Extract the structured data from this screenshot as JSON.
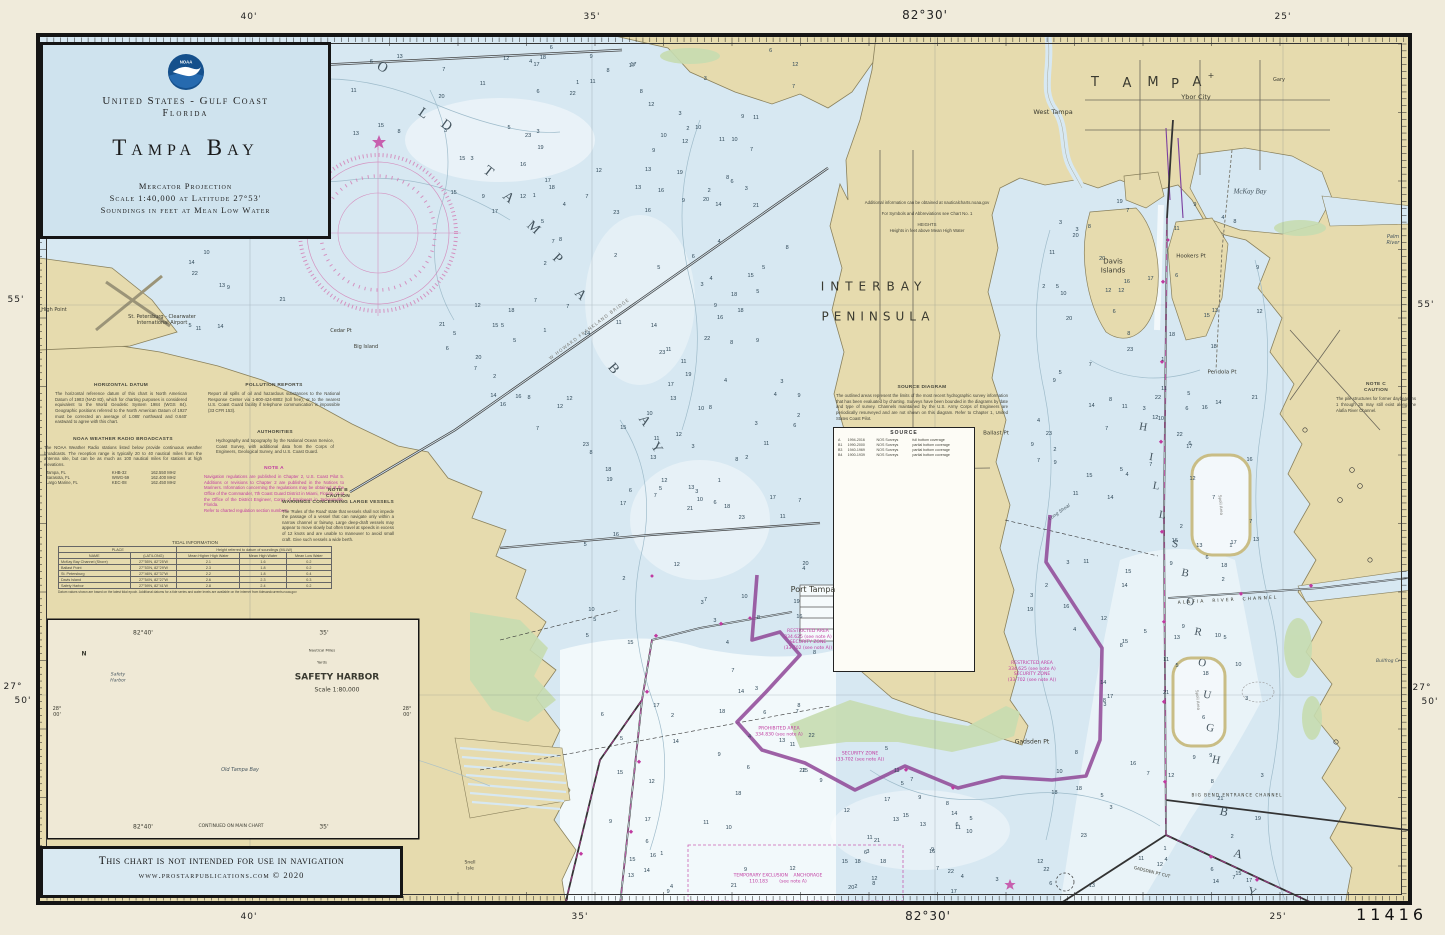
{
  "chart": {
    "number": "11416"
  },
  "title_block": {
    "region": "United States - Gulf Coast",
    "state": "Florida",
    "title": "Tampa Bay",
    "projection": "Mercator Projection",
    "scale": "Scale 1:40,000 at Latitude 27°53'",
    "soundings_note": "Soundings in feet at Mean Low Water",
    "logo": "noaa-logo"
  },
  "disclaimer": {
    "line1": "This chart is not intended for use in navigation",
    "line2": "www.prostarpublications.com  © 2020"
  },
  "colors": {
    "land": "#e6dbae",
    "water": "#d7e8f2",
    "marsh": "#c7dcb0",
    "deep": "#f7fbfd",
    "magenta": "#c03aa0",
    "purple": "#8f4796",
    "teal": "#9ccfcd",
    "titlebox": "#cfe3ee"
  },
  "margin_labels": [
    {
      "t": "40'",
      "x": 249,
      "y": 17
    },
    {
      "t": "35'",
      "x": 592,
      "y": 17
    },
    {
      "t": "82°30'",
      "x": 925,
      "y": 15,
      "s": 12
    },
    {
      "t": "25'",
      "x": 1283,
      "y": 17
    },
    {
      "t": "40'",
      "x": 249,
      "y": 917
    },
    {
      "t": "35'",
      "x": 580,
      "y": 917
    },
    {
      "t": "82°30'",
      "x": 928,
      "y": 916,
      "s": 12
    },
    {
      "t": "25'",
      "x": 1278,
      "y": 917
    },
    {
      "t": "55'",
      "x": 16,
      "y": 300
    },
    {
      "t": "27°",
      "x": 13,
      "y": 687
    },
    {
      "t": "50'",
      "x": 23,
      "y": 701
    },
    {
      "t": "55'",
      "x": 1426,
      "y": 305
    },
    {
      "t": "27°",
      "x": 1422,
      "y": 688
    },
    {
      "t": "50'",
      "x": 1430,
      "y": 702
    }
  ],
  "notes": [
    {
      "id": "horizontal-datum",
      "title": "HORIZONTAL DATUM",
      "x": 55,
      "y": 383,
      "w": 132,
      "body": "The horizontal reference datum of this chart is North American Datum of 1983 (NAD 83), which for charting purposes is considered equivalent to the World Geodetic System 1984 (WGS 84). Geographic positions referred to the North American Datum of 1927 must be corrected an average of 1.085' northward and 0.640' eastward to agree with this chart."
    },
    {
      "id": "weather-radio",
      "title": "NOAA WEATHER RADIO BROADCASTS",
      "x": 44,
      "y": 437,
      "w": 158,
      "body": "The NOAA Weather Radio stations listed below provide continuous weather broadcasts. The reception range is typically 20 to 40 nautical miles from the antenna site, but can be as much as 100 nautical miles for stations at high elevations.",
      "rows": [
        [
          "Tampa, FL",
          "KHB-32",
          "162.550 MHz"
        ],
        [
          "Sarasota, FL",
          "WWG-59",
          "162.400 MHz"
        ],
        [
          "Largo Marine, FL",
          "KEC-08",
          "162.450 MHz"
        ]
      ]
    },
    {
      "id": "pollution-reports",
      "title": "POLLUTION REPORTS",
      "x": 208,
      "y": 383,
      "w": 132,
      "body": "Report all spills of oil and hazardous substances to the National Response Center via 1-800-424-8802 (toll free), or to the nearest U.S. Coast Guard facility if telephone communication is impossible (33 CFR 153)."
    },
    {
      "id": "authorities",
      "title": "AUTHORITIES",
      "x": 216,
      "y": 430,
      "w": 118,
      "body": "Hydrography and topography by the National Ocean Service, Coast Survey, with additional data from the Corps of Engineers, Geological Survey, and U.S. Coast Guard."
    },
    {
      "id": "note-a",
      "title": "NOTE A",
      "x": 204,
      "y": 466,
      "w": 140,
      "c": "mag",
      "body": "Navigation regulations are published in Chapter 2, U.S. Coast Pilot 5. Additions or revisions to Chapter 2 are published in the Notices to Mariners. Information concerning the regulations may be obtained at the Office of the Commander, 7th Coast Guard District in Miami, Florida, or at the Office of the District Engineer, Corps of Engineers in Jacksonville, Florida.\nRefer to charted regulation section numbers."
    },
    {
      "id": "note-b",
      "title": "NOTE B\nCAUTION\nWARNINGS CONCERNING LARGE VESSELS",
      "x": 282,
      "y": 488,
      "w": 112,
      "body": "The 'Rules of the Road' state that vessels shall not impede the passage of a vessel that can navigate only within a narrow channel or fairway. Large deep-draft vessels may appear to move slowly but often travel at speeds in excess of 12 knots and are unable to maneuver to avoid small craft. Give such vessels a wide berth."
    },
    {
      "id": "heights",
      "title": "",
      "x": 862,
      "y": 200,
      "w": 130,
      "c": "center",
      "body": "Additional information can be obtained at nauticalcharts.noaa.gov\n\nFor Symbols and Abbreviations see Chart No. 1\n\nHEIGHTS\nHeights in feet above Mean High Water"
    },
    {
      "id": "note-c",
      "title": "NOTE C\nCAUTION",
      "x": 1336,
      "y": 382,
      "w": 80,
      "body": "The pile structures for former daybeacons 1 through 35 may still exist along the Alafia River Channel."
    },
    {
      "id": "source-diagram",
      "title": "SOURCE DIAGRAM",
      "x": 836,
      "y": 385,
      "w": 172,
      "body": "The outlined areas represent the limits of the most recent hydrographic survey information that has been evaluated by charting. Surveys have been bounded in the diagrams by date and type of survey. Channels maintained by the U.S. Army Corps of Engineers are periodically resurveyed and are not shown on this diagram. Refer to Chapter 1, United States Coast Pilot."
    }
  ],
  "source_table": {
    "title": "SOURCE",
    "rows": [
      [
        "A",
        "1994-2016",
        "NOS Surveys",
        "full bottom coverage"
      ],
      [
        "B1",
        "1990-2000",
        "NOS Surveys",
        "partial bottom coverage"
      ],
      [
        "B3",
        "1940-1969",
        "NOS Surveys",
        "partial bottom coverage"
      ],
      [
        "B4",
        "1900-1939",
        "NOS Surveys",
        "partial bottom coverage"
      ]
    ]
  },
  "tide_table": {
    "title": "TIDAL INFORMATION",
    "col_place": "PLACE",
    "col_heights": "Height referred to datum of soundings (MLLW)",
    "sub_headers": [
      "NAME",
      "(LAT/LONG)",
      "Mean Higher High Water",
      "Mean High Water",
      "Mean Low Water"
    ],
    "rows": [
      [
        "McKay Bay Channel (Shore)",
        "27°55'N, 82°25'W",
        "2.1",
        "1.6",
        "0.2"
      ],
      [
        "Ballast Point",
        "27°53'N, 82°29'W",
        "2.3",
        "1.8",
        "0.2"
      ],
      [
        "St. Petersburg",
        "27°46'N, 82°37'W",
        "2.2",
        "1.8",
        "0.4"
      ],
      [
        "Davis Island",
        "27°54'N, 82°27'W",
        "2.6",
        "2.3",
        "0.3"
      ],
      [
        "Safety Harbor",
        "27°59'N, 82°41'W",
        "2.8",
        "2.4",
        "0.2"
      ]
    ],
    "footnote": "Datum values shown are based on the latest tidal epoch. Additional datums for a tide series and water levels are available on the internet from tidesandcurrents.noaa.gov"
  },
  "inset": {
    "title": "SAFETY HARBOR",
    "scale": "Scale 1:80,000",
    "continued": "CONTINUED ON MAIN CHART",
    "lon_label": "82°40'",
    "min_label": "35'",
    "lat_label": "28°\n00'",
    "bar1": "Nautical Miles",
    "bar2": "Yards"
  },
  "map_labels": [
    {
      "t": "O",
      "x": 382,
      "y": 68,
      "s": 14,
      "c": "dk",
      "f": 1,
      "r": 30
    },
    {
      "t": "L",
      "x": 423,
      "y": 114,
      "s": 14,
      "c": "dk",
      "f": 1,
      "r": 34
    },
    {
      "t": "D",
      "x": 446,
      "y": 126,
      "s": 14,
      "c": "dk",
      "f": 1,
      "r": 36
    },
    {
      "t": "T",
      "x": 488,
      "y": 172,
      "s": 14,
      "c": "dk",
      "f": 1,
      "r": 38
    },
    {
      "t": "A",
      "x": 508,
      "y": 198,
      "s": 14,
      "c": "dk",
      "f": 1,
      "r": 40
    },
    {
      "t": "M",
      "x": 533,
      "y": 228,
      "s": 14,
      "c": "dk",
      "f": 1,
      "r": 42
    },
    {
      "t": "P",
      "x": 557,
      "y": 259,
      "s": 14,
      "c": "dk",
      "f": 1,
      "r": 44
    },
    {
      "t": "A",
      "x": 580,
      "y": 295,
      "s": 14,
      "c": "dk",
      "f": 1,
      "r": 46
    },
    {
      "t": "B",
      "x": 613,
      "y": 369,
      "s": 14,
      "c": "dk",
      "f": 1,
      "r": 50
    },
    {
      "t": "A",
      "x": 644,
      "y": 421,
      "s": 14,
      "c": "dk",
      "f": 1,
      "r": 55
    },
    {
      "t": "Y",
      "x": 656,
      "y": 448,
      "s": 14,
      "c": "dk",
      "f": 1,
      "r": 58
    },
    {
      "t": "T",
      "x": 1095,
      "y": 83,
      "s": 13
    },
    {
      "t": "A",
      "x": 1127,
      "y": 84,
      "s": 13
    },
    {
      "t": "M",
      "x": 1153,
      "y": 83,
      "s": 13
    },
    {
      "t": "P",
      "x": 1175,
      "y": 85,
      "s": 13
    },
    {
      "t": "A",
      "x": 1197,
      "y": 83,
      "s": 13
    },
    {
      "t": "+",
      "x": 1211,
      "y": 76,
      "s": 8
    },
    {
      "t": "H",
      "x": 1143,
      "y": 428,
      "s": 11,
      "c": "dk",
      "f": 1,
      "r": 10
    },
    {
      "t": "I",
      "x": 1151,
      "y": 458,
      "s": 11,
      "c": "dk",
      "f": 1,
      "r": 10
    },
    {
      "t": "L",
      "x": 1156,
      "y": 487,
      "s": 11,
      "c": "dk",
      "f": 1,
      "r": 10
    },
    {
      "t": "L",
      "x": 1162,
      "y": 516,
      "s": 11,
      "c": "dk",
      "f": 1,
      "r": 10
    },
    {
      "t": "S",
      "x": 1175,
      "y": 545,
      "s": 11,
      "c": "dk",
      "f": 1,
      "r": 12
    },
    {
      "t": "B",
      "x": 1185,
      "y": 574,
      "s": 11,
      "c": "dk",
      "f": 1,
      "r": 12
    },
    {
      "t": "O",
      "x": 1190,
      "y": 603,
      "s": 11,
      "c": "dk",
      "f": 1,
      "r": 12
    },
    {
      "t": "R",
      "x": 1198,
      "y": 633,
      "s": 11,
      "c": "dk",
      "f": 1,
      "r": 12
    },
    {
      "t": "O",
      "x": 1202,
      "y": 664,
      "s": 11,
      "c": "dk",
      "f": 1,
      "r": 12
    },
    {
      "t": "U",
      "x": 1207,
      "y": 696,
      "s": 11,
      "c": "dk",
      "f": 1,
      "r": 12
    },
    {
      "t": "G",
      "x": 1210,
      "y": 729,
      "s": 11,
      "c": "dk",
      "f": 1,
      "r": 12
    },
    {
      "t": "H",
      "x": 1216,
      "y": 761,
      "s": 11,
      "c": "dk",
      "f": 1,
      "r": 12
    },
    {
      "t": "B",
      "x": 1224,
      "y": 812,
      "s": 12,
      "c": "dk",
      "f": 1,
      "r": 14
    },
    {
      "t": "A",
      "x": 1238,
      "y": 854,
      "s": 12,
      "c": "dk",
      "f": 1,
      "r": 16
    },
    {
      "t": "Y",
      "x": 1252,
      "y": 892,
      "s": 12,
      "c": "dk",
      "f": 1,
      "r": 18
    },
    {
      "t": "INTERBAY",
      "x": 874,
      "y": 287,
      "s": 12,
      "ls": 6
    },
    {
      "t": "PENINSULA",
      "x": 878,
      "y": 317,
      "s": 12,
      "ls": 5
    },
    {
      "t": "Port Tampa",
      "x": 813,
      "y": 590,
      "s": 8
    },
    {
      "t": "Davis\nIslands",
      "x": 1113,
      "y": 266,
      "s": 7
    },
    {
      "t": "McKay Bay",
      "x": 1250,
      "y": 192,
      "s": 7,
      "i": 1,
      "f": 1,
      "c": "dk"
    },
    {
      "t": "Ybor City",
      "x": 1196,
      "y": 97,
      "s": 6.5
    },
    {
      "t": "West Tampa",
      "x": 1053,
      "y": 112,
      "s": 6.5
    },
    {
      "t": "Gary",
      "x": 1279,
      "y": 80,
      "s": 5
    },
    {
      "t": "Hookers Pt",
      "x": 1191,
      "y": 257,
      "s": 5.5
    },
    {
      "t": "Pendola Pt",
      "x": 1222,
      "y": 373,
      "s": 5.5
    },
    {
      "t": "Ballast Pt",
      "x": 996,
      "y": 434,
      "s": 5.5
    },
    {
      "t": "Gadsden Pt",
      "x": 1032,
      "y": 742,
      "s": 6
    },
    {
      "t": "Cedar Pt",
      "x": 341,
      "y": 331,
      "s": 5
    },
    {
      "t": "Big Island",
      "x": 366,
      "y": 347,
      "s": 5
    },
    {
      "t": "High Point",
      "x": 54,
      "y": 310,
      "s": 5
    },
    {
      "t": "Snell\nIsle",
      "x": 470,
      "y": 866,
      "s": 4.5
    },
    {
      "t": "St. Petersburg - Clearwater\nInternational Airport",
      "x": 162,
      "y": 320,
      "s": 5
    },
    {
      "t": "W HOWARD FRANKLAND BRIDGE",
      "x": 590,
      "y": 330,
      "s": 4.5,
      "c": "gry",
      "r": -37,
      "ls": 1
    },
    {
      "t": "Long Shoal",
      "x": 1060,
      "y": 513,
      "s": 4.5,
      "i": 1,
      "c": "dk",
      "r": -35
    },
    {
      "t": "Spoil Area",
      "x": 1221,
      "y": 505,
      "s": 4,
      "c": "gry",
      "r": 85
    },
    {
      "t": "Spoil Area",
      "x": 1198,
      "y": 700,
      "s": 4,
      "c": "gry",
      "r": 85
    },
    {
      "t": "Palm\nRiver",
      "x": 1393,
      "y": 240,
      "s": 5,
      "i": 1,
      "c": "dk"
    },
    {
      "t": "Bullfrog Cr",
      "x": 1388,
      "y": 662,
      "s": 4.5,
      "i": 1,
      "c": "dk"
    },
    {
      "t": "ALAFIA  RIVER  CHANNEL",
      "x": 1228,
      "y": 601,
      "s": 4.5,
      "ls": 2,
      "r": -3
    },
    {
      "t": "BIG BEND ENTRANCE CHANNEL",
      "x": 1237,
      "y": 795,
      "s": 4.2,
      "ls": 1
    },
    {
      "t": "GADSDEN PT CUT",
      "x": 1152,
      "y": 872,
      "s": 4.2,
      "r": 14
    },
    {
      "t": "RESTRICTED AREA\n334.625 (see note A)\nSECURITY ZONE\n(33-702 (see note A))",
      "x": 1032,
      "y": 672,
      "s": 4.5,
      "c": "mag"
    },
    {
      "t": "RESTRICTED AREA\n334.625 (see note A)\nSECURITY ZONE\n(33-702 (see note A))",
      "x": 808,
      "y": 640,
      "s": 4.5,
      "c": "mag"
    },
    {
      "t": "PROHIBITED AREA\n334.830 (see note A)",
      "x": 779,
      "y": 732,
      "s": 4.5,
      "c": "mag"
    },
    {
      "t": "SECURITY ZONE\n(33-702 (see note A))",
      "x": 860,
      "y": 757,
      "s": 4.5,
      "c": "mag"
    },
    {
      "t": "TEMPORARY EXCLUSION    ANCHORAGE\n110.183        (see note A)",
      "x": 778,
      "y": 879,
      "s": 4.5,
      "c": "mag"
    },
    {
      "t": "INTERBAY",
      "x": 874,
      "y": 287,
      "s": 0.1
    },
    {
      "t": "SAFETY HARBOR",
      "x": 337,
      "y": 678,
      "s": 9,
      "b": 1
    },
    {
      "t": "Scale 1:80,000",
      "x": 337,
      "y": 690,
      "s": 6
    },
    {
      "t": "CONTINUED ON MAIN CHART",
      "x": 231,
      "y": 827,
      "s": 4.5
    },
    {
      "t": "82°40'",
      "x": 143,
      "y": 633,
      "s": 6
    },
    {
      "t": "35'",
      "x": 324,
      "y": 633,
      "s": 6
    },
    {
      "t": "82°40'",
      "x": 143,
      "y": 827,
      "s": 6
    },
    {
      "t": "35'",
      "x": 324,
      "y": 827,
      "s": 6
    },
    {
      "t": "28°\n00'",
      "x": 57,
      "y": 712,
      "s": 5
    },
    {
      "t": "28°\n00'",
      "x": 407,
      "y": 712,
      "s": 5
    },
    {
      "t": "Nautical Miles",
      "x": 322,
      "y": 651,
      "s": 3.8
    },
    {
      "t": "Yards",
      "x": 322,
      "y": 663,
      "s": 3.8
    },
    {
      "t": "N",
      "x": 84,
      "y": 654,
      "s": 6,
      "b": 1
    },
    {
      "t": "Safety\nHarbor",
      "x": 118,
      "y": 678,
      "s": 4.5,
      "i": 1,
      "c": "dk"
    },
    {
      "t": "Old Tampa Bay",
      "x": 240,
      "y": 770,
      "s": 5,
      "i": 1,
      "c": "dk"
    }
  ],
  "soundings": [
    3,
    5,
    7,
    9,
    11,
    12,
    13,
    15,
    17,
    18,
    21,
    22,
    2,
    4,
    6,
    8,
    10,
    14,
    16,
    19,
    23,
    1,
    3,
    7,
    12,
    9,
    5,
    11,
    15,
    8,
    6,
    13,
    10,
    17,
    4,
    20,
    2,
    9,
    14,
    7,
    11,
    3,
    16,
    5,
    12,
    8,
    18,
    6
  ]
}
